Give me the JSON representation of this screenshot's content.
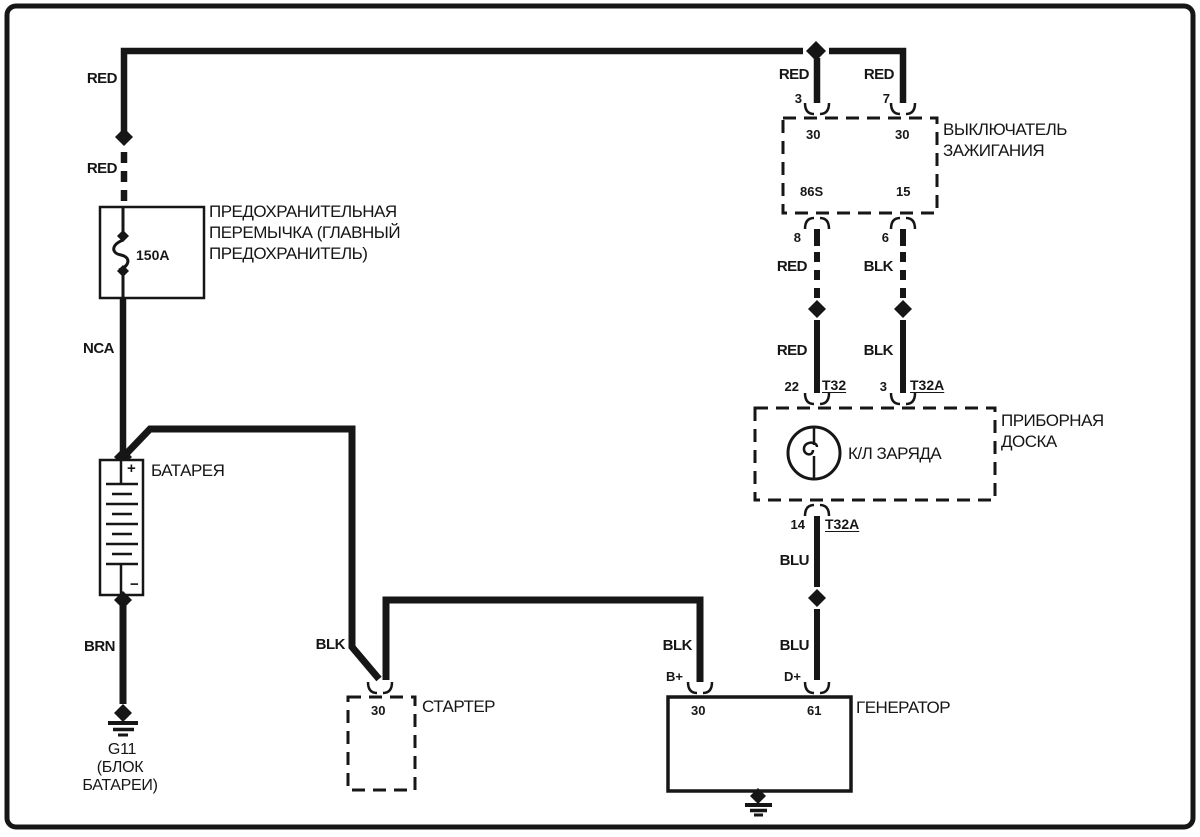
{
  "canvas": {
    "background": "#ffffff",
    "line_color": "#161616"
  },
  "main_feed": {
    "red_upper": "RED",
    "red_lower": "RED"
  },
  "fuse": {
    "rating": "150A",
    "name_lines": [
      "ПРЕДОХРАНИТЕЛЬНАЯ",
      "ПЕРЕМЫЧКА (ГЛАВНЫЙ",
      "ПРЕДОХРАНИТЕЛЬ)"
    ],
    "wire_below": "NCA"
  },
  "battery": {
    "name": "БАТАРЕЯ",
    "plus": "+",
    "minus": "−",
    "wire_below": "BRN",
    "ground_lines": [
      "G11",
      "(БЛОК",
      "БАТАРЕИ)"
    ]
  },
  "starter": {
    "wire": "BLK",
    "pin": "30",
    "name": "СТАРТЕР"
  },
  "generator": {
    "wire_b": "BLK",
    "term_b": "B+",
    "pin_30": "30",
    "pin_61": "61",
    "term_d": "D+",
    "wire_d": "BLU",
    "name": "ГЕНЕРАТОР"
  },
  "ignition_switch": {
    "name_lines": [
      "ВЫКЛЮЧАТЕЛЬ",
      "ЗАЖИГАНИЯ"
    ],
    "feed_left": {
      "wire": "RED",
      "pin": "3",
      "term": "30"
    },
    "feed_right": {
      "wire": "RED",
      "pin": "7",
      "term": "30"
    },
    "out_left": {
      "term": "86S",
      "pin": "8",
      "wire_a": "RED",
      "wire_b": "RED"
    },
    "out_right": {
      "term": "15",
      "pin": "6",
      "wire_a": "BLK",
      "wire_b": "BLK"
    }
  },
  "instrument_panel": {
    "name_lines": [
      "ПРИБОРНАЯ",
      "ДОСКА"
    ],
    "lamp": "К/Л ЗАРЯДА",
    "in_left": {
      "pin": "22",
      "connector": "T32"
    },
    "in_right": {
      "pin": "3",
      "connector": "T32A"
    },
    "out": {
      "pin": "14",
      "connector": "T32A",
      "wire": "BLU"
    }
  }
}
